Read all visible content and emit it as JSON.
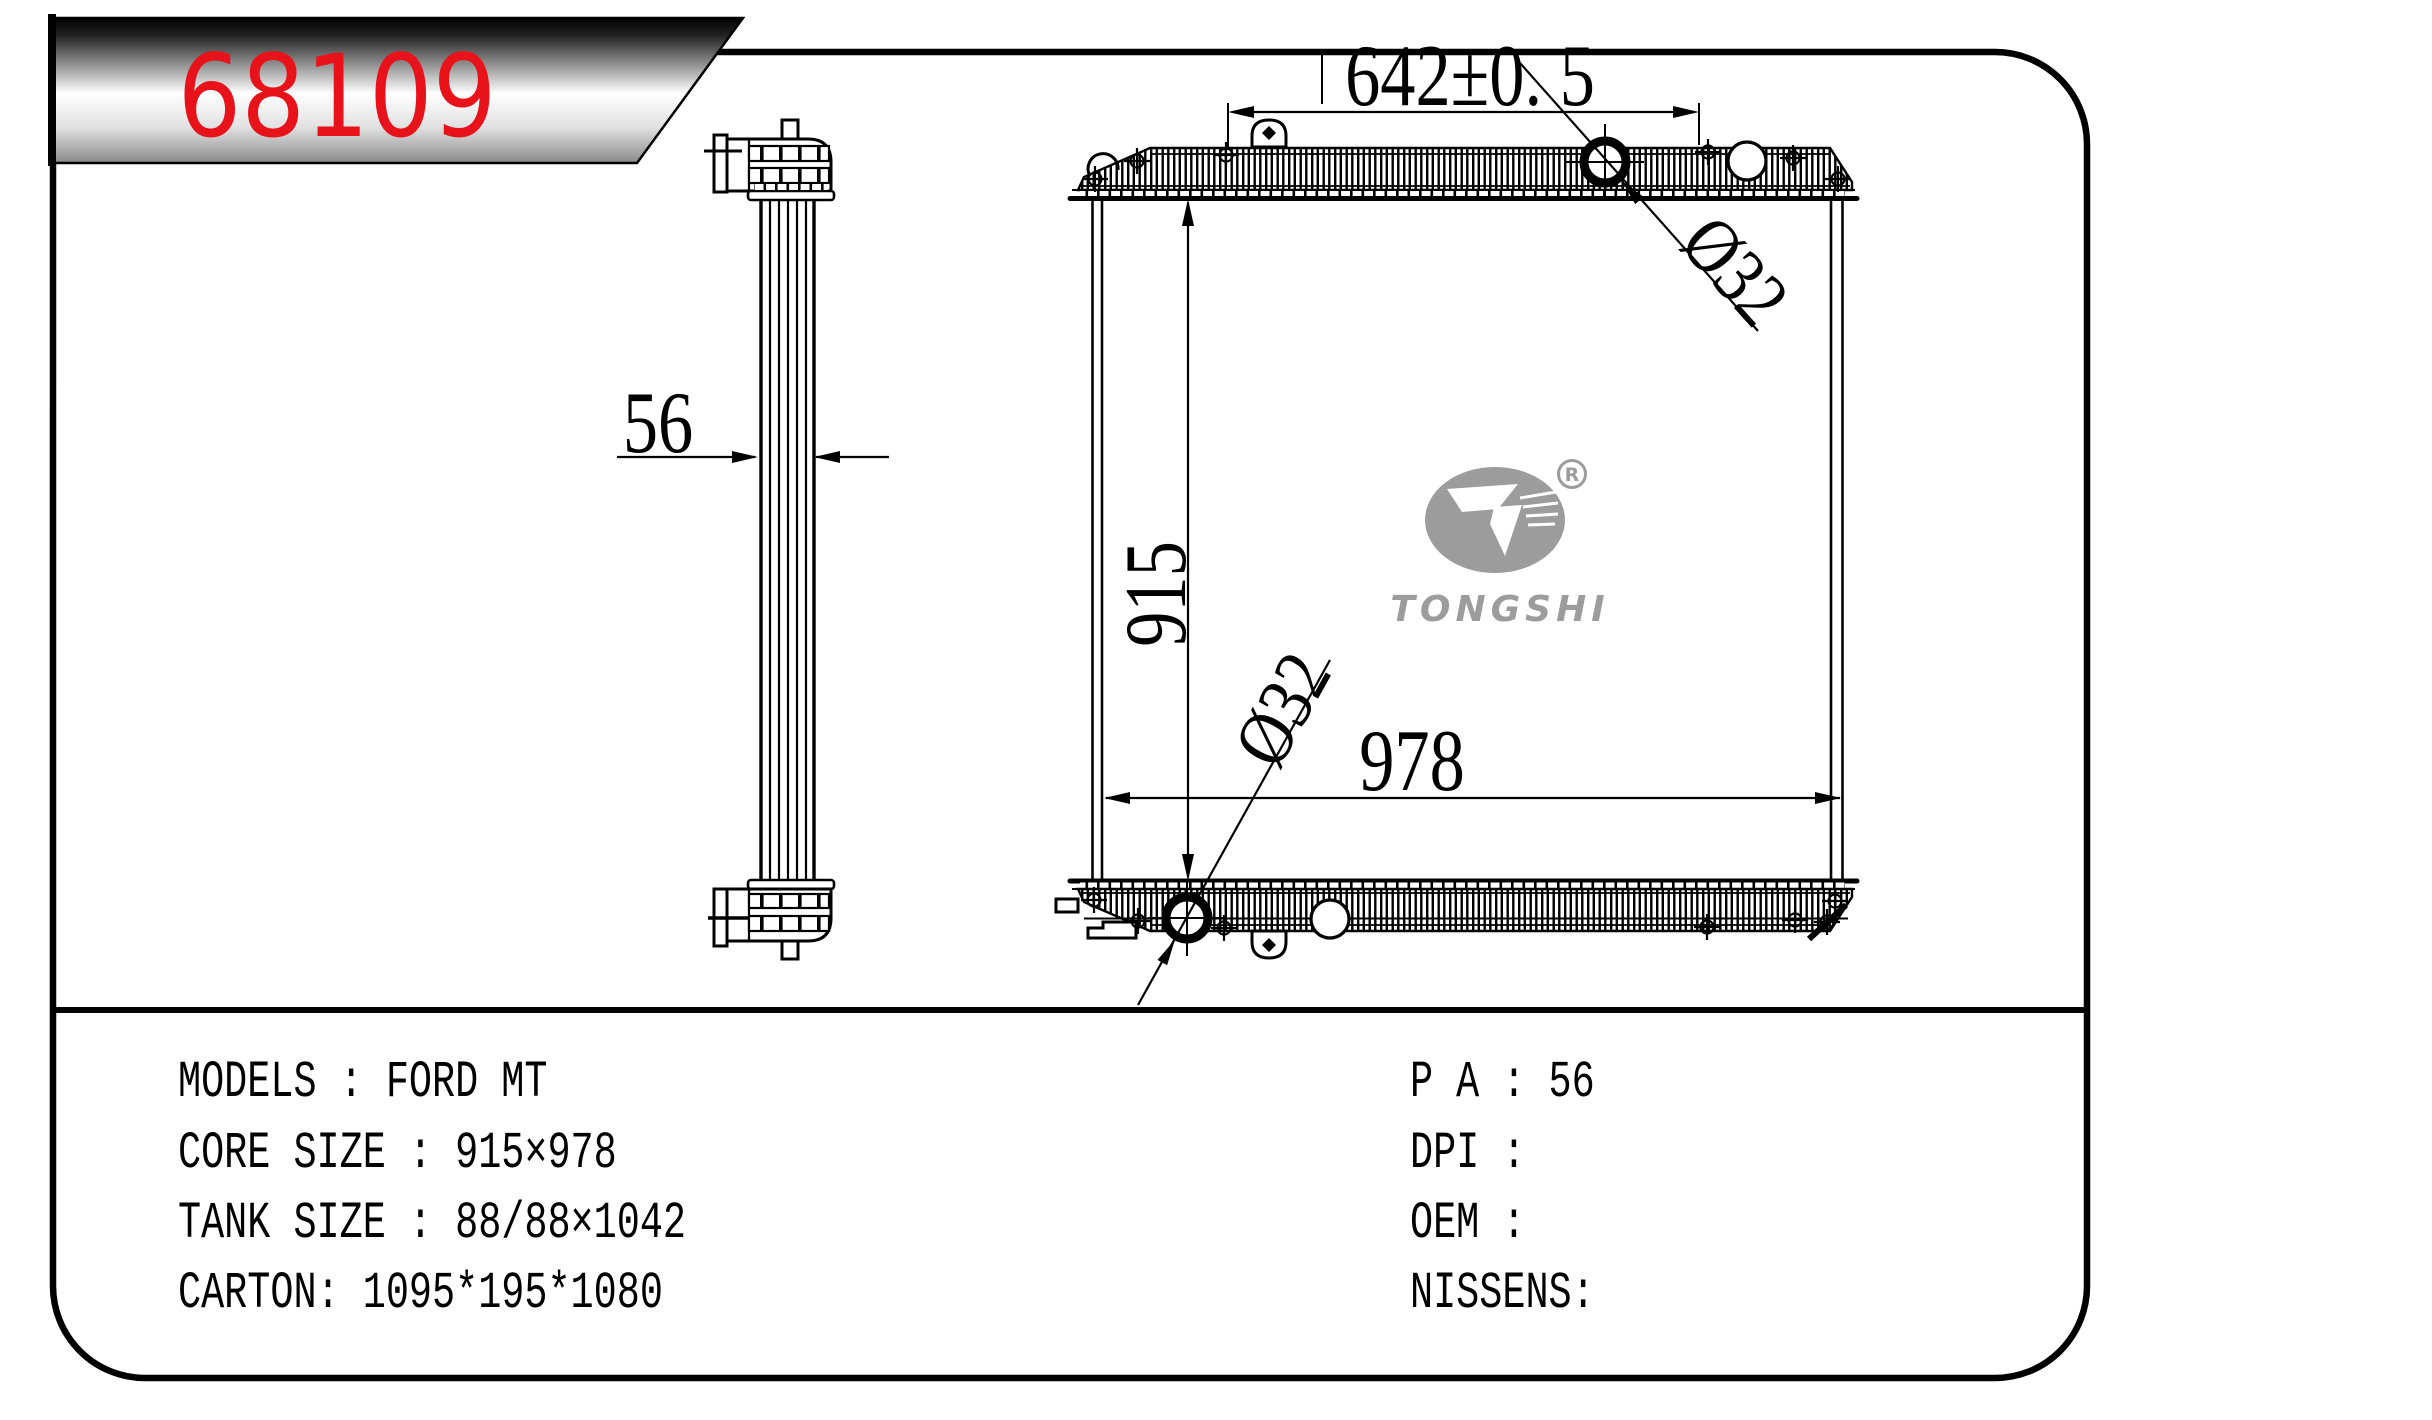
{
  "banner": {
    "part_number": "68109",
    "accent_color": "#e8121a"
  },
  "logo": {
    "brand": "TONGSHI",
    "registered_mark": "R"
  },
  "drawing": {
    "dim_top_width": "642±0. 5",
    "dim_core_height": "915",
    "dim_core_width": "978",
    "dim_thickness": "56",
    "dim_top_port": "Ø32",
    "dim_bottom_port": "Ø32"
  },
  "specs": {
    "left": [
      "MODELS : FORD MT",
      "CORE SIZE : 915×978",
      "TANK SIZE : 88/88×1042",
      "CARTON: 1095*195*1080"
    ],
    "right": [
      "P A : 56",
      "DPI :",
      "OEM :",
      "NISSENS:"
    ]
  }
}
